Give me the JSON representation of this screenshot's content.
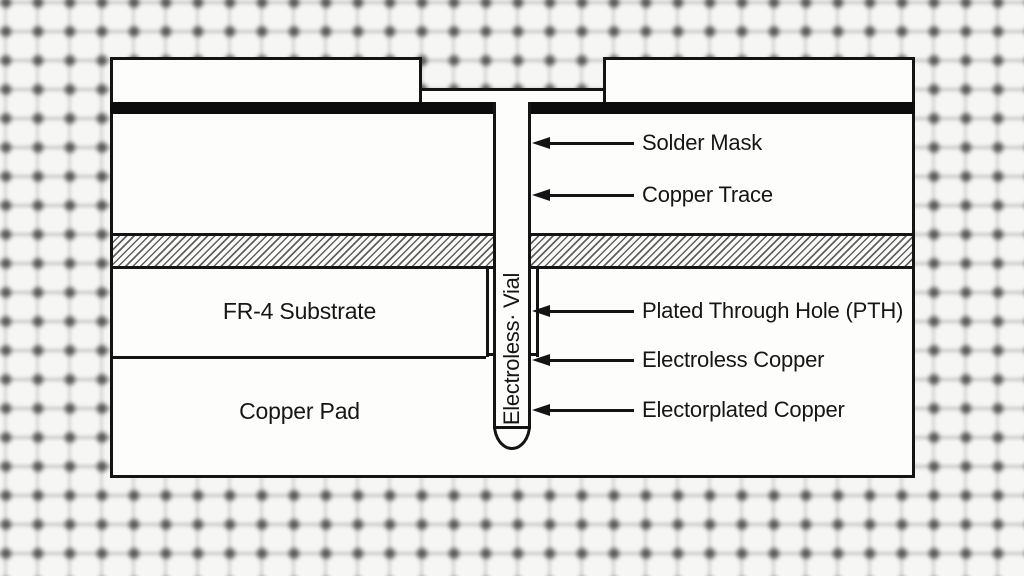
{
  "diagram": {
    "via_label": "Electroless· Vial",
    "callouts": [
      {
        "label": "Solder Mask"
      },
      {
        "label": "Copper Trace"
      },
      {
        "label": "Plated Through Hole (PTH)"
      },
      {
        "label": "Electroless Copper"
      },
      {
        "label": "Electorplated Copper"
      }
    ],
    "regions": {
      "substrate": "FR-4 Substrate",
      "pad": "Copper Pad"
    },
    "colors": {
      "line": "#141414",
      "solder_mask_band": "#0c0c0c",
      "surface": "#fdfdfc",
      "background": "#f6f6f5",
      "text": "#161616"
    }
  }
}
